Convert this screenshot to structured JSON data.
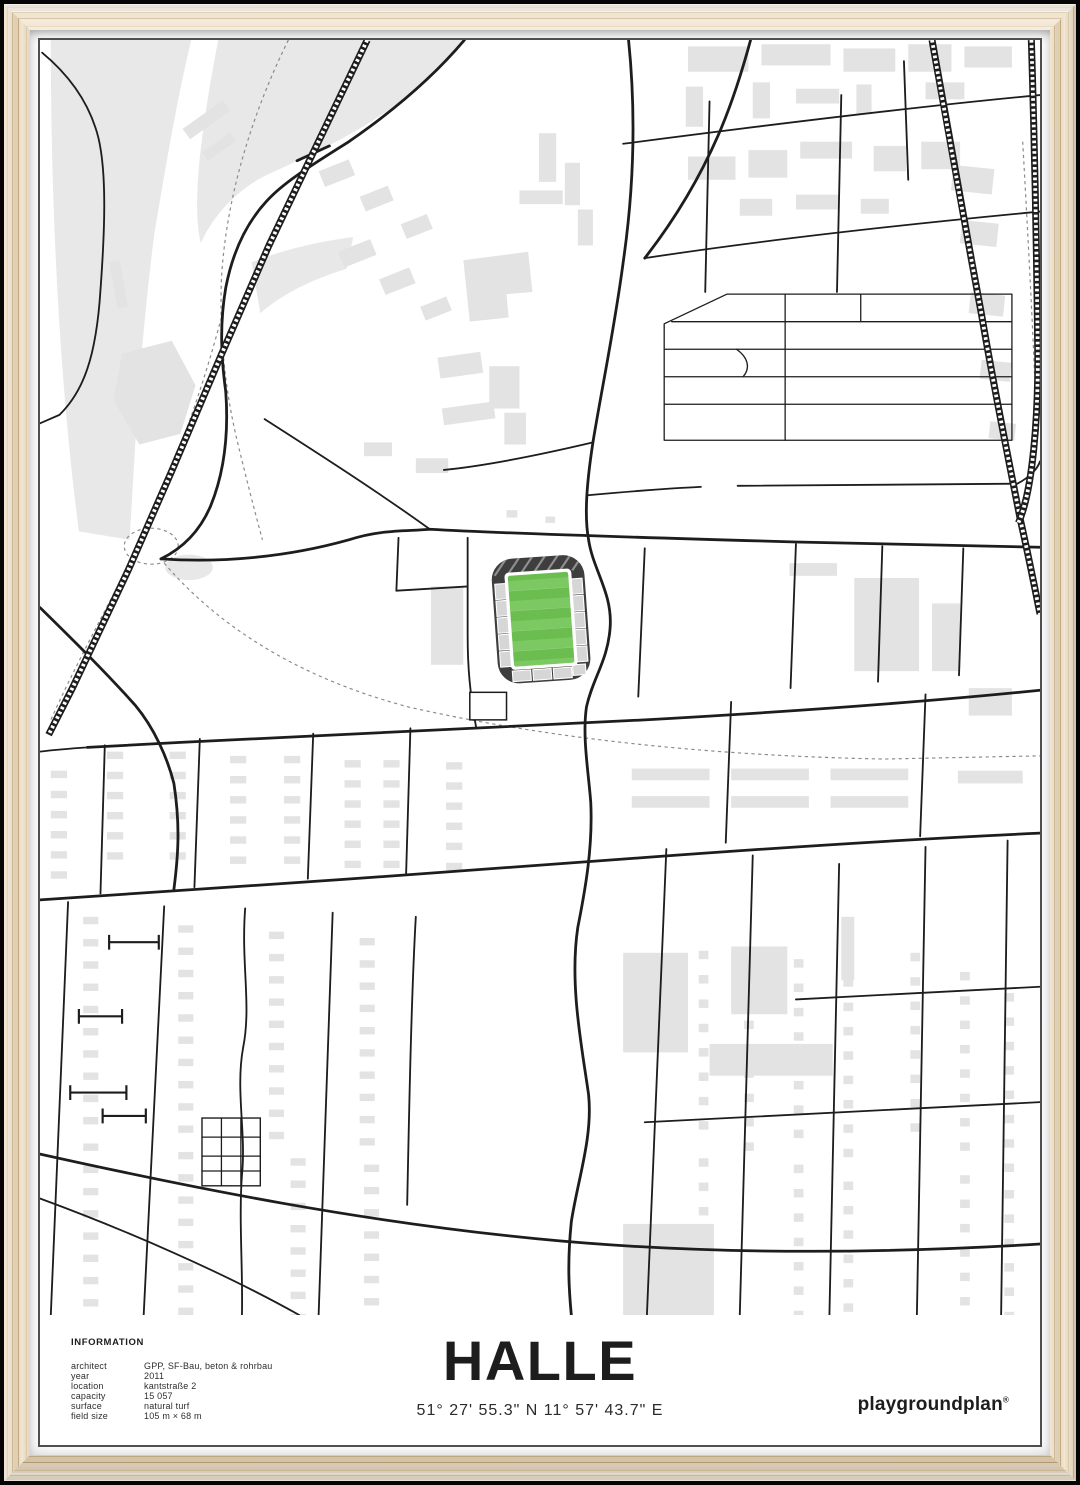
{
  "poster": {
    "title": "HALLE",
    "coordinates": "51° 27' 55.3\" N 11° 57' 43.7\" E",
    "brand": "playgroundplan",
    "brand_mark": "®",
    "information": {
      "heading": "INFORMATION",
      "rows": [
        {
          "label": "architect",
          "value": "GPP, SF-Bau, beton & rohrbau"
        },
        {
          "label": "year",
          "value": "2011"
        },
        {
          "label": "location",
          "value": "kantstraße 2"
        },
        {
          "label": "capacity",
          "value": "15 057"
        },
        {
          "label": "surface",
          "value": "natural turf"
        },
        {
          "label": "field size",
          "value": "105 m × 68 m"
        }
      ]
    }
  },
  "map": {
    "description": "minimalist street map of Halle around the stadium",
    "stadium": {
      "pitch_color": "#6bbd4f",
      "pitch_stripe_color": "#7cc862",
      "stand_color": "#3e3e3e",
      "seating_color": "#d6d6d6"
    },
    "road_color": "#1d1d1d",
    "building_color": "#e3e3e3",
    "background_color": "#ffffff",
    "path_dash_color": "#8a8a8a"
  },
  "frame": {
    "wood_color": "#e7d6b8",
    "mat_color": "#ffffff",
    "backdrop_color": "#000000",
    "poster_border_color": "#4f4f4f"
  }
}
